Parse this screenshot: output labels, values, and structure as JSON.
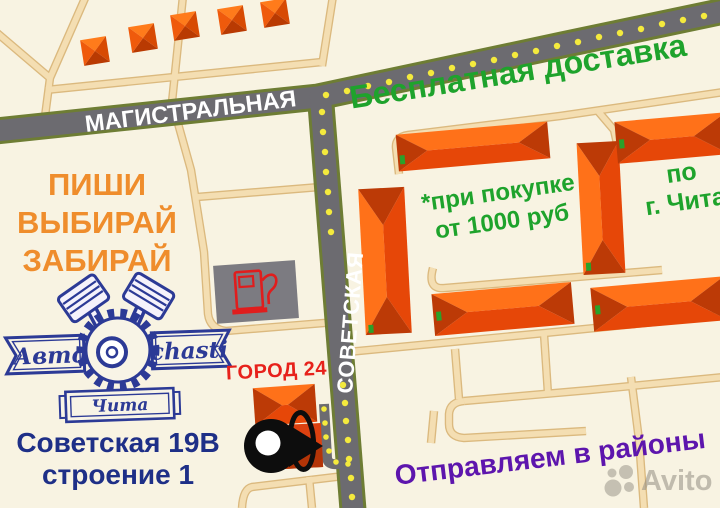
{
  "promo": {
    "slogan_line1": "ПИШИ",
    "slogan_line2": "ВЫБИРАЙ",
    "slogan_line3": "ЗАБИРАЙ",
    "free_delivery": "Бесплатная доставка",
    "delivery_condition_line1": "*при покупке",
    "delivery_condition_line2": "от 1000 руб",
    "delivery_area_line1": "по",
    "delivery_area_line2": "г. Чита",
    "districts_shipping": "Отправляем в районы"
  },
  "streets": {
    "horizontal_street": "МАГИСТРАЛЬНАЯ",
    "vertical_street": "СОВЕТСКАЯ"
  },
  "store": {
    "name_part1": "Авто",
    "name_part2": "chasti",
    "city": "Чита",
    "landmark": "ГОРОД 24",
    "address_line1": "Советская 19В",
    "address_line2": "строение 1"
  },
  "watermark": {
    "brand": "Avito"
  },
  "colors": {
    "background": "#f8f3e2",
    "road_fill": "#6c6b70",
    "road_edge": "#6e7d34",
    "road_dots": "#f4ea3d",
    "minor_road": "#f4deb2",
    "building_orange": "#f1490a",
    "promo_orange": "#ef8d2c",
    "promo_green": "#1ea32c",
    "brand_navy": "#2c3a96",
    "address_blue": "#1e2f87",
    "landmark_red": "#e7211b",
    "districts_purple": "#5d15ad"
  }
}
